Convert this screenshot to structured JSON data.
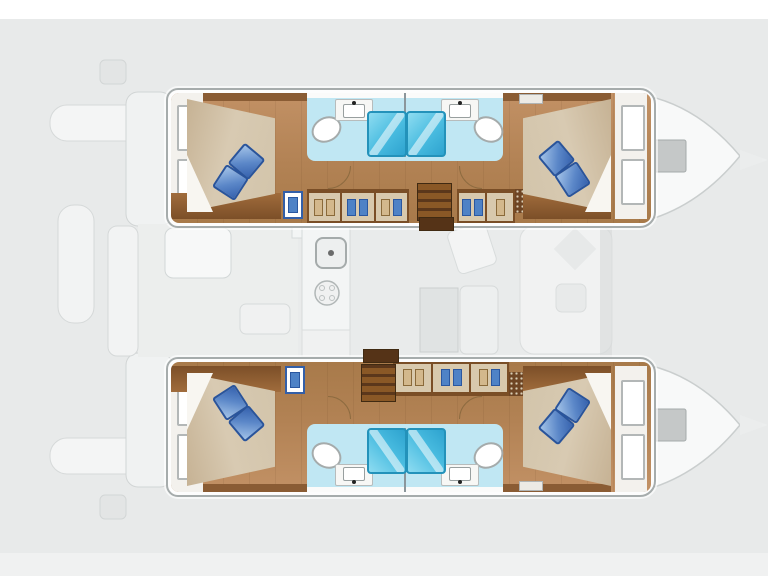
{
  "page": {
    "background": "#e8eaea",
    "top_band": "#ffffff",
    "bottom_band": "#f0f1f1"
  },
  "diagram": {
    "kind": "catamaran-deck-plan",
    "orientation": "bow-right",
    "hulls": [
      {
        "id": "port-hull",
        "position": "top",
        "cabins": [
          {
            "id": "aft-cabin",
            "bed": "double",
            "pillows": 2,
            "windows": 2
          },
          {
            "id": "forward-cabin",
            "bed": "double",
            "pillows": 2,
            "windows": 2
          }
        ],
        "bathrooms": [
          {
            "id": "aft-bathroom",
            "fixtures": [
              "shower",
              "toilet",
              "sink-counter"
            ]
          },
          {
            "id": "forward-bathroom",
            "fixtures": [
              "shower",
              "toilet",
              "sink-counter"
            ]
          }
        ],
        "features": [
          "companionway-steps",
          "wardrobes-with-clothes",
          "blue-locker",
          "vent-cabinet",
          "bow-hatch"
        ]
      },
      {
        "id": "starboard-hull",
        "position": "bottom",
        "cabins": [
          {
            "id": "aft-cabin",
            "bed": "double",
            "pillows": 2,
            "windows": 2
          },
          {
            "id": "forward-cabin",
            "bed": "double",
            "pillows": 2,
            "windows": 2
          }
        ],
        "bathrooms": [
          {
            "id": "aft-bathroom",
            "fixtures": [
              "shower",
              "toilet",
              "sink-counter"
            ]
          },
          {
            "id": "forward-bathroom",
            "fixtures": [
              "shower",
              "toilet",
              "sink-counter"
            ]
          }
        ],
        "features": [
          "companionway-steps",
          "wardrobes-with-clothes",
          "blue-locker",
          "vent-cabinet",
          "bow-hatch"
        ]
      }
    ],
    "bridge_deck": {
      "areas": [
        {
          "id": "aft-cockpit",
          "items": [
            "cockpit-table",
            "bench-seat",
            "transom-steps",
            "tender-platform",
            "davit-arms"
          ]
        },
        {
          "id": "salon",
          "items": [
            "galley-counter",
            "galley-sink",
            "stove",
            "dining-table",
            "sofa",
            "chaise-seat"
          ]
        },
        {
          "id": "forward-cockpit",
          "items": [
            "lounge-panel",
            "diamond-seat",
            "small-seat",
            "mast-beam"
          ]
        }
      ]
    },
    "colors": {
      "hull_outline": "#a6acac",
      "wood_floor": "#b28254",
      "dark_wood": "#8a5c34",
      "bed_beige": "#d8cab2",
      "pillow_blue": "#3662ae",
      "bathroom_floor": "#c0e7f3",
      "shower_blue": "#49bce0",
      "steps_brown": "#5b371b",
      "wardrobe_trim": "#7a4e26",
      "faint_deck": "#f3f4f4"
    }
  },
  "aria": {
    "stage": "Catamaran interior layout plan, bow pointing right",
    "port_hull": "Port hull: aft double cabin, two bathrooms with showers amidships, wardrobes, forward double cabin",
    "starboard_hull": "Starboard hull: aft double cabin, two bathrooms with showers amidships, wardrobes, forward double cabin",
    "deck": "Faint deck outline: aft cockpit with table, salon with galley and dining table, forward cockpit, twin bows"
  }
}
